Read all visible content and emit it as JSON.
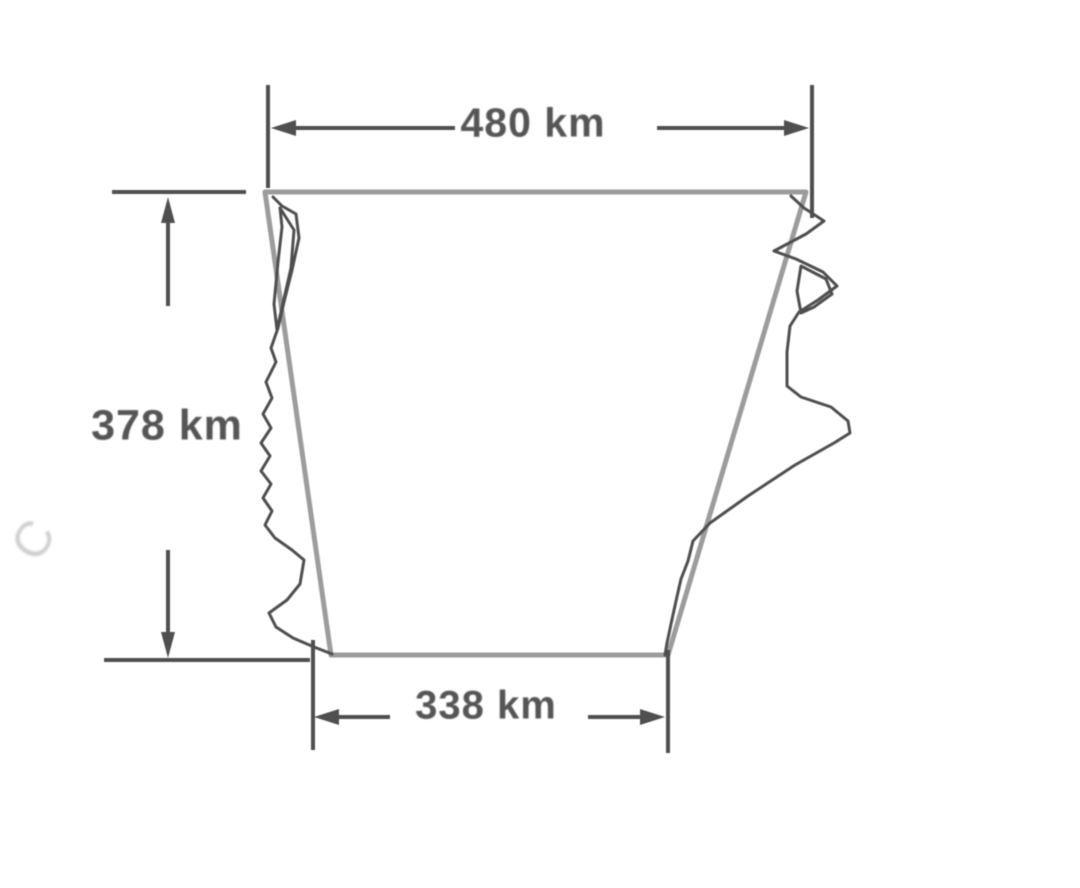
{
  "figure": {
    "type": "geometry-measurement-diagram",
    "description": "Irregular map-like region outline approximated by a trapezoid, annotated with three measured dimensions",
    "dimensions": {
      "top": {
        "label": "480 km",
        "value_km": 480,
        "role": "top parallel side"
      },
      "left": {
        "label": "378 km",
        "value_km": 378,
        "role": "height"
      },
      "bottom": {
        "label": "338 km",
        "value_km": 338,
        "role": "bottom parallel side"
      }
    },
    "watermark": "X\nC"
  },
  "colors": {
    "background": "#ffffff",
    "trapezoid_outline": "#9c9c9c",
    "irregular_border": "#4f4f4f",
    "dimension_lines": "#4f4f4f",
    "label_text": "#555555",
    "watermark": "#c4c4c4"
  }
}
